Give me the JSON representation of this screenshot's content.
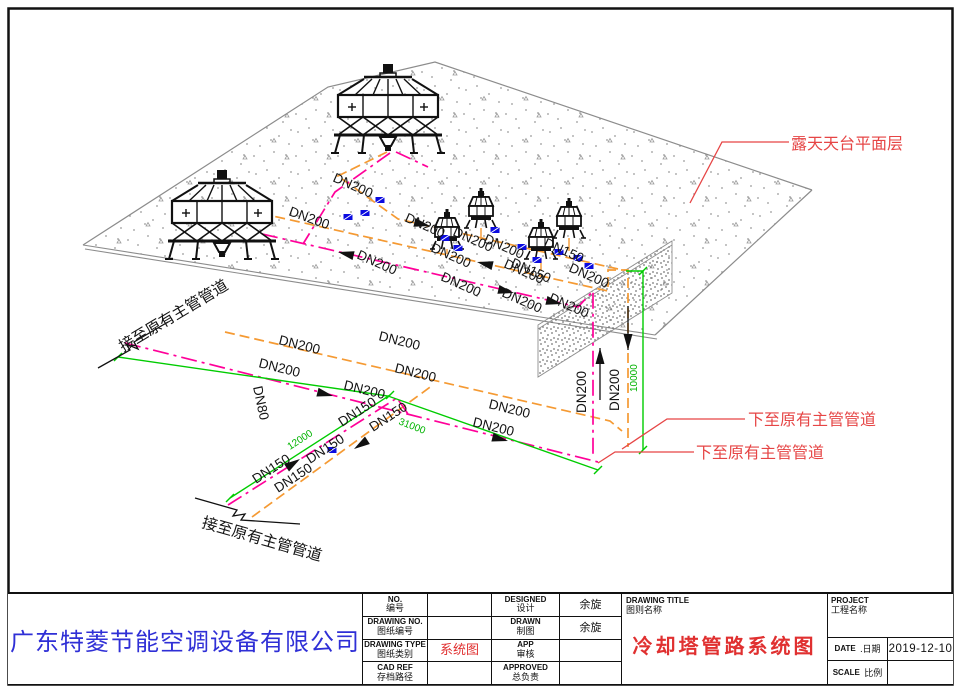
{
  "title_block": {
    "company": "广东特菱节能空调设备有限公司",
    "col1": [
      {
        "en": "NO.",
        "cn": "编号"
      },
      {
        "en": "DRAWING NO.",
        "cn": "图纸编号"
      },
      {
        "en": "DRAWING TYPE",
        "cn": "图纸类别"
      },
      {
        "en": "CAD REF",
        "cn": "存档路径"
      }
    ],
    "col2": [
      "",
      "",
      "系统图",
      ""
    ],
    "col3": [
      {
        "en": "DESIGNED",
        "cn": "设计"
      },
      {
        "en": "DRAWN",
        "cn": "制图"
      },
      {
        "en": "APP",
        "cn": "审核"
      },
      {
        "en": "APPROVED",
        "cn": "总负责"
      }
    ],
    "col4": [
      "余旋",
      "余旋",
      "",
      ""
    ],
    "drawing_title": {
      "en": "DRAWING TITLE",
      "cn": "图则名称",
      "value": "冷却塔管路系统图"
    },
    "project": {
      "en": "PROJECT",
      "cn": "工程名称",
      "value": ""
    },
    "date": {
      "en": "DATE",
      "cn": ".日期",
      "value": "2019-12-10"
    },
    "scale": {
      "en": "SCALE",
      "cn": "比例",
      "value": ""
    }
  },
  "drawing": {
    "colors": {
      "orange_pipe": "#f59a33",
      "magenta_pipe": "#ff0099",
      "dimension_green": "#00cc00",
      "annotation_red": "#e64545",
      "valve_blue": "#0b0be0",
      "company_blue": "#2f2fd6",
      "title_red": "#e03030"
    },
    "pipe_labels": [
      {
        "text": "DN200",
        "x": 332,
        "y": 181,
        "r": 24
      },
      {
        "text": "DN200",
        "x": 288,
        "y": 215,
        "r": 20
      },
      {
        "text": "DN200",
        "x": 404,
        "y": 221,
        "r": 24
      },
      {
        "text": "DN200",
        "x": 452,
        "y": 235,
        "r": 24
      },
      {
        "text": "DN200",
        "x": 483,
        "y": 242,
        "r": 24
      },
      {
        "text": "DN200",
        "x": 356,
        "y": 258,
        "r": 24
      },
      {
        "text": "DN200",
        "x": 430,
        "y": 251,
        "r": 24
      },
      {
        "text": "DN200",
        "x": 503,
        "y": 267,
        "r": 24
      },
      {
        "text": "DN200",
        "x": 568,
        "y": 271,
        "r": 24
      },
      {
        "text": "DN200",
        "x": 440,
        "y": 280,
        "r": 24
      },
      {
        "text": "DN200",
        "x": 501,
        "y": 296,
        "r": 24
      },
      {
        "text": "DN200",
        "x": 548,
        "y": 301,
        "r": 24
      },
      {
        "text": "DN150",
        "x": 543,
        "y": 246,
        "r": 24
      },
      {
        "text": "DN150",
        "x": 510,
        "y": 266,
        "r": 24
      },
      {
        "text": "DN200",
        "x": 278,
        "y": 344,
        "r": 14
      },
      {
        "text": "DN200",
        "x": 394,
        "y": 372,
        "r": 14
      },
      {
        "text": "DN200",
        "x": 258,
        "y": 367,
        "r": 14
      },
      {
        "text": "DN200",
        "x": 343,
        "y": 389,
        "r": 14
      },
      {
        "text": "DN200",
        "x": 378,
        "y": 340,
        "r": 14
      },
      {
        "text": "DN200",
        "x": 472,
        "y": 426,
        "r": 14
      },
      {
        "text": "DN200",
        "x": 488,
        "y": 408,
        "r": 14
      },
      {
        "text": "DN80",
        "x": 253,
        "y": 387,
        "r": 78
      },
      {
        "text": "DN200",
        "x": 586,
        "y": 413,
        "r": -90
      },
      {
        "text": "DN200",
        "x": 619,
        "y": 411,
        "r": -90
      },
      {
        "text": "DN150",
        "x": 256,
        "y": 484,
        "r": -33
      },
      {
        "text": "DN150",
        "x": 278,
        "y": 493,
        "r": -33
      },
      {
        "text": "DN150",
        "x": 310,
        "y": 464,
        "r": -33
      },
      {
        "text": "DN150",
        "x": 342,
        "y": 427,
        "r": -33
      },
      {
        "text": "DN150",
        "x": 373,
        "y": 432,
        "r": -33
      }
    ],
    "dim_labels": [
      {
        "text": "12000",
        "x": 290,
        "y": 450,
        "r": -33
      },
      {
        "text": "31000",
        "x": 398,
        "y": 424,
        "r": 21
      },
      {
        "text": "10000",
        "x": 637,
        "y": 392,
        "r": -90
      }
    ],
    "black_notes": [
      {
        "text": "接至原有主管管道",
        "x": 123,
        "y": 352,
        "r": -31
      },
      {
        "text": "接至原有主管管道",
        "x": 201,
        "y": 527,
        "r": 16
      }
    ],
    "red_notes": [
      {
        "text": "露天天台平面层",
        "x": 791,
        "y": 149,
        "r": 0
      },
      {
        "text": "下至原有主管管道",
        "x": 748,
        "y": 425,
        "r": 0
      },
      {
        "text": "下至原有主管管道",
        "x": 696,
        "y": 458,
        "r": 0
      }
    ],
    "flow_arrows": [
      {
        "x": 430,
        "y": 226,
        "a": 13
      },
      {
        "x": 477,
        "y": 262,
        "a": 193
      },
      {
        "x": 338,
        "y": 252,
        "a": 193
      },
      {
        "x": 514,
        "y": 293,
        "a": 13
      },
      {
        "x": 562,
        "y": 304,
        "a": 13
      },
      {
        "x": 333,
        "y": 396,
        "a": 14
      },
      {
        "x": 508,
        "y": 441,
        "a": 14
      },
      {
        "x": 300,
        "y": 459,
        "a": -33
      },
      {
        "x": 354,
        "y": 449,
        "a": 147
      },
      {
        "x": 600,
        "y": 348,
        "a": -90,
        "tail": 36
      },
      {
        "x": 628,
        "y": 350,
        "a": 90,
        "tail": 28
      }
    ],
    "valves": [
      {
        "x": 380,
        "y": 200
      },
      {
        "x": 348,
        "y": 217
      },
      {
        "x": 365,
        "y": 213
      },
      {
        "x": 445,
        "y": 238
      },
      {
        "x": 458,
        "y": 248
      },
      {
        "x": 495,
        "y": 230
      },
      {
        "x": 522,
        "y": 247
      },
      {
        "x": 537,
        "y": 260
      },
      {
        "x": 559,
        "y": 252
      },
      {
        "x": 578,
        "y": 258
      },
      {
        "x": 589,
        "y": 266
      },
      {
        "x": 332,
        "y": 450
      }
    ]
  }
}
